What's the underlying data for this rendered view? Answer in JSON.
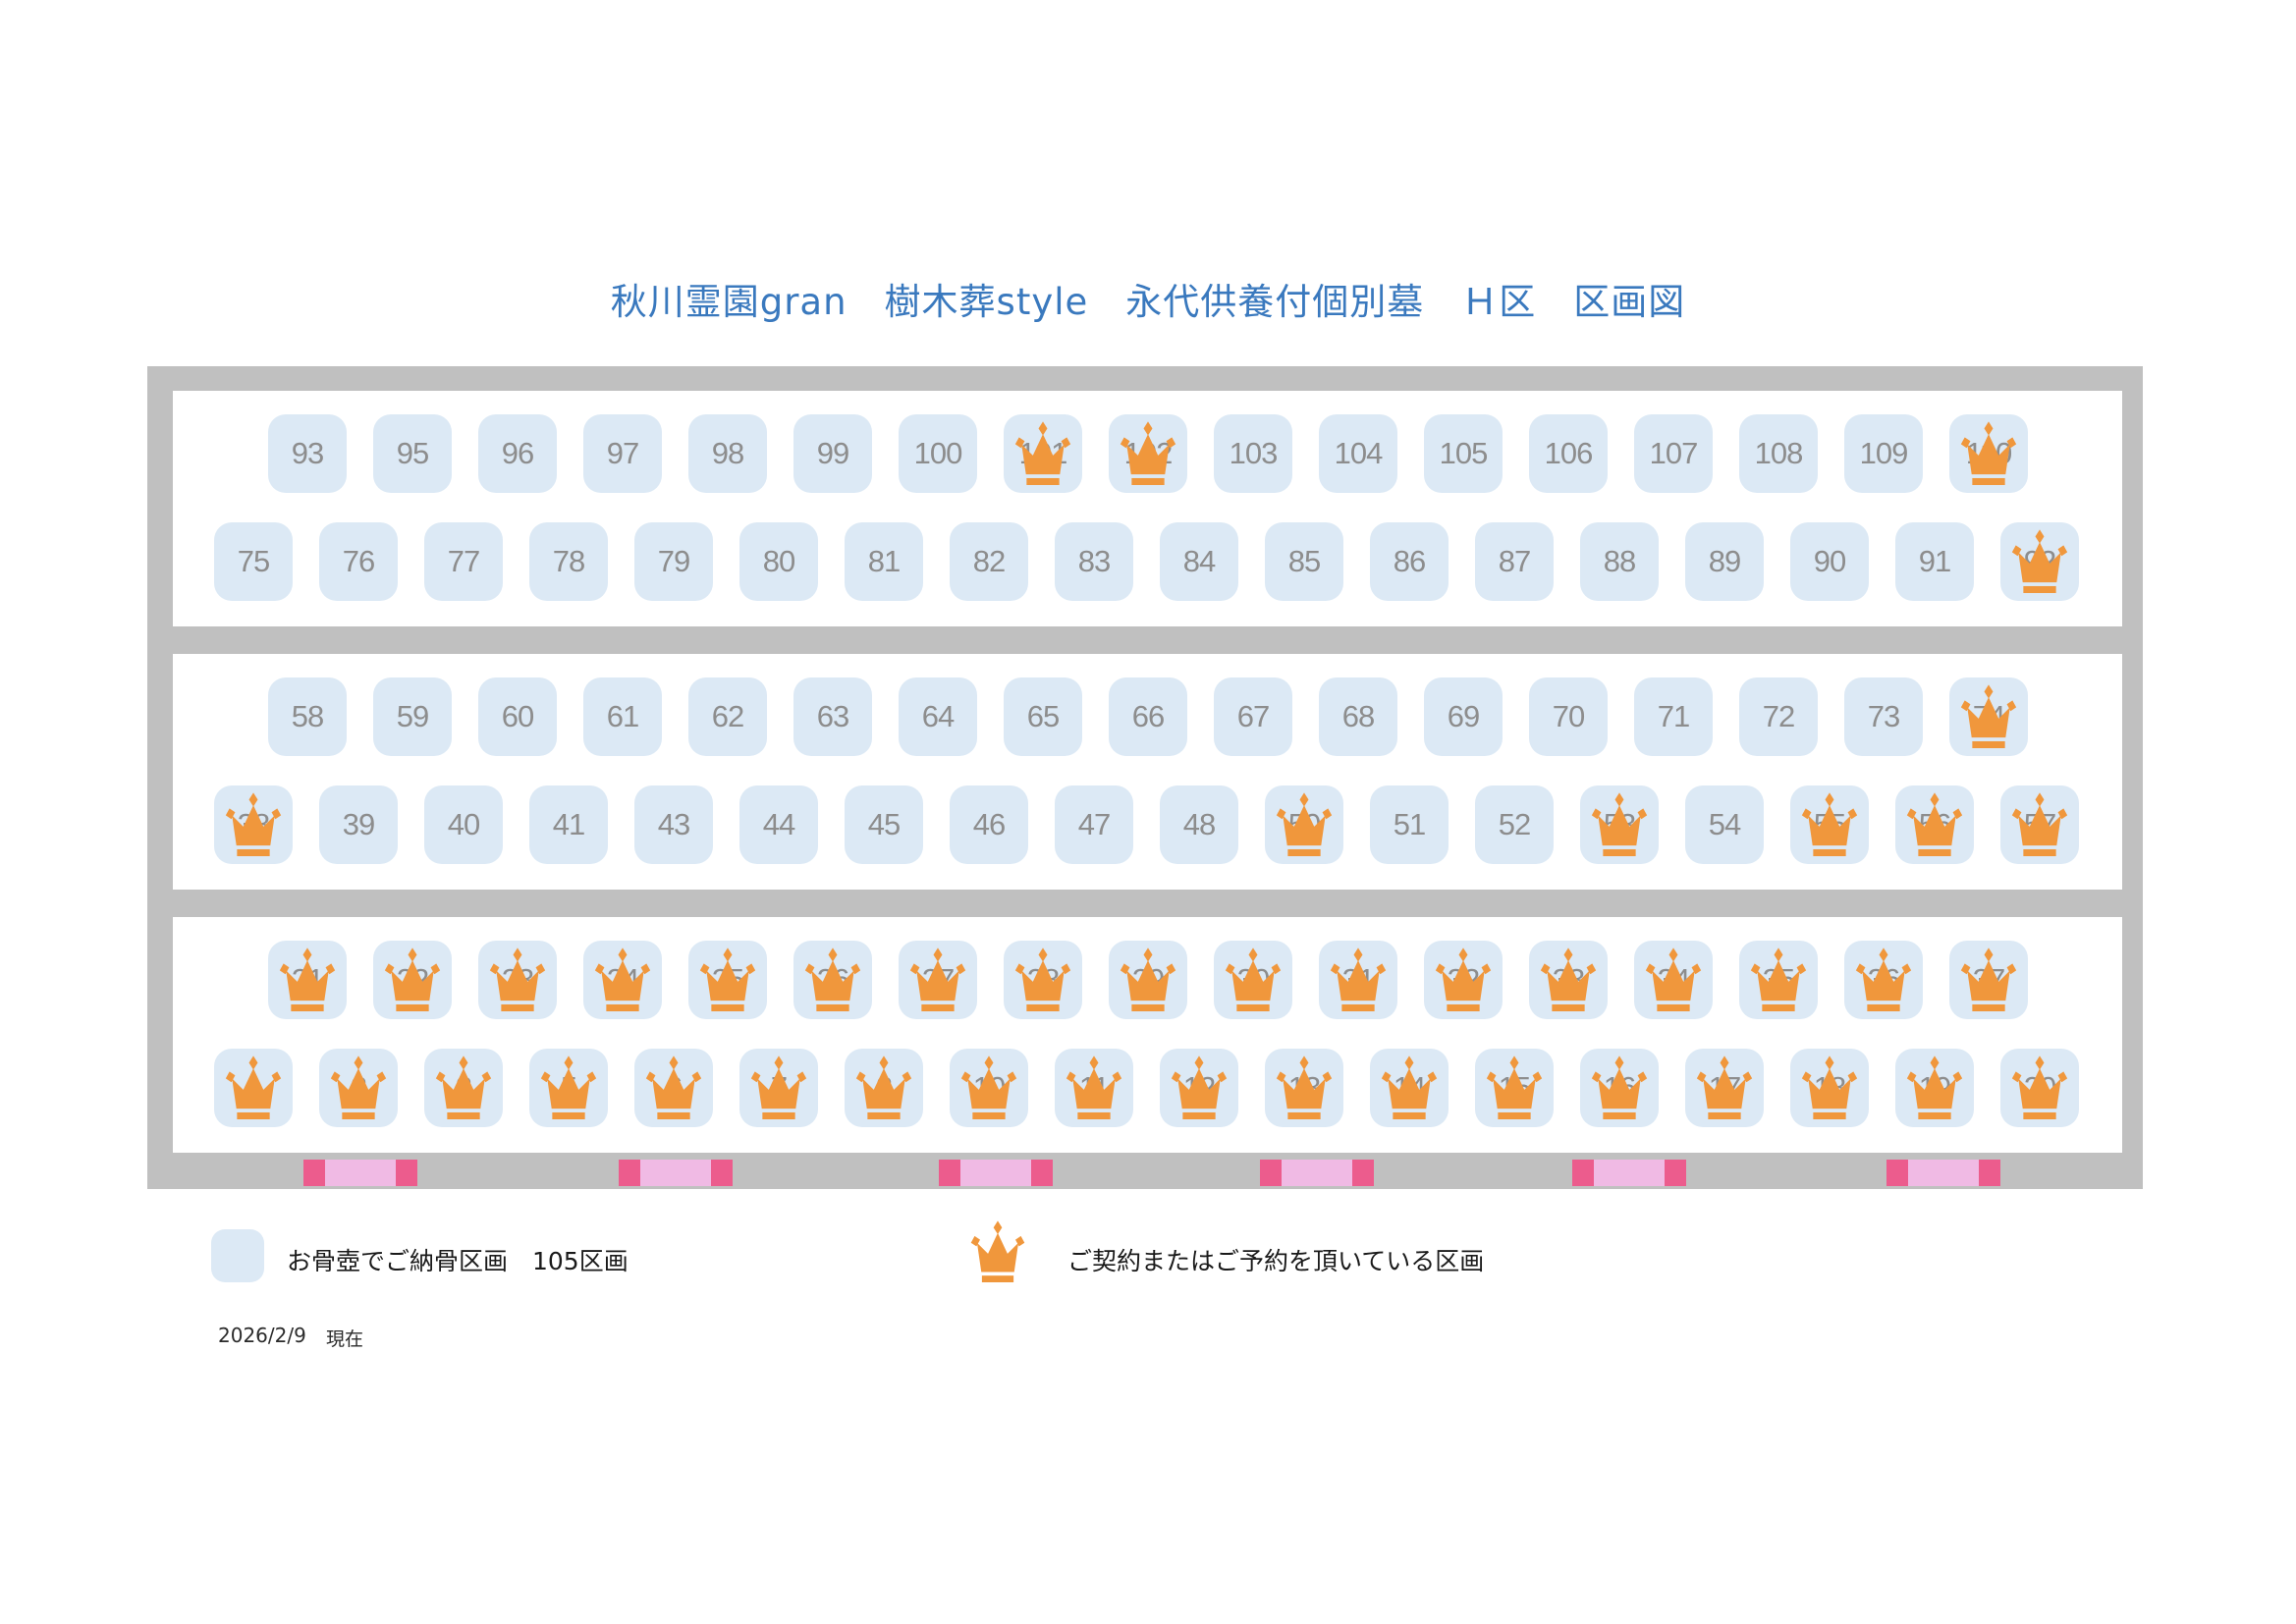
{
  "title": "秋川霊園gran　樹木葬style　永代供養付個別墓　Ｈ区　区画図",
  "colors": {
    "title_blue": "#3A79BE",
    "cell_background": "#DCE9F5",
    "number_gray": "#8D8D8D",
    "frame_gray": "#C0C0C0",
    "crown_orange": "#F0973C",
    "marker_dark_pink": "#EC5C8D",
    "marker_light_pink": "#F0BAE4"
  },
  "map": {
    "path_marker_count": 6,
    "rows": [
      {
        "lines": [
          {
            "cells": [
              {
                "n": "93"
              },
              {
                "n": "95"
              },
              {
                "n": "96"
              },
              {
                "n": "97"
              },
              {
                "n": "98"
              },
              {
                "n": "99"
              },
              {
                "n": "100"
              },
              {
                "n": "101",
                "crown": true
              },
              {
                "n": "102",
                "crown": true
              },
              {
                "n": "103"
              },
              {
                "n": "104"
              },
              {
                "n": "105"
              },
              {
                "n": "106"
              },
              {
                "n": "107"
              },
              {
                "n": "108"
              },
              {
                "n": "109"
              },
              {
                "n": "110",
                "crown": true
              }
            ]
          },
          {
            "cells": [
              {
                "n": "75"
              },
              {
                "n": "76"
              },
              {
                "n": "77"
              },
              {
                "n": "78"
              },
              {
                "n": "79"
              },
              {
                "n": "80"
              },
              {
                "n": "81"
              },
              {
                "n": "82"
              },
              {
                "n": "83"
              },
              {
                "n": "84"
              },
              {
                "n": "85"
              },
              {
                "n": "86"
              },
              {
                "n": "87"
              },
              {
                "n": "88"
              },
              {
                "n": "89"
              },
              {
                "n": "90"
              },
              {
                "n": "91"
              },
              {
                "n": "92",
                "crown": true
              }
            ]
          }
        ]
      },
      {
        "lines": [
          {
            "cells": [
              {
                "n": "58"
              },
              {
                "n": "59"
              },
              {
                "n": "60"
              },
              {
                "n": "61"
              },
              {
                "n": "62"
              },
              {
                "n": "63"
              },
              {
                "n": "64"
              },
              {
                "n": "65"
              },
              {
                "n": "66"
              },
              {
                "n": "67"
              },
              {
                "n": "68"
              },
              {
                "n": "69"
              },
              {
                "n": "70"
              },
              {
                "n": "71"
              },
              {
                "n": "72"
              },
              {
                "n": "73"
              },
              {
                "n": "74",
                "crown": true
              }
            ]
          },
          {
            "cells": [
              {
                "n": "38",
                "crown": true
              },
              {
                "n": "39"
              },
              {
                "n": "40"
              },
              {
                "n": "41"
              },
              {
                "n": "43"
              },
              {
                "n": "44"
              },
              {
                "n": "45"
              },
              {
                "n": "46"
              },
              {
                "n": "47"
              },
              {
                "n": "48"
              },
              {
                "n": "50",
                "crown": true
              },
              {
                "n": "51"
              },
              {
                "n": "52"
              },
              {
                "n": "53",
                "crown": true
              },
              {
                "n": "54"
              },
              {
                "n": "55",
                "crown": true
              },
              {
                "n": "56",
                "crown": true
              },
              {
                "n": "57",
                "crown": true
              }
            ]
          }
        ]
      },
      {
        "lines": [
          {
            "cells": [
              {
                "n": "21",
                "crown": true
              },
              {
                "n": "22",
                "crown": true
              },
              {
                "n": "23",
                "crown": true
              },
              {
                "n": "24",
                "crown": true
              },
              {
                "n": "25",
                "crown": true
              },
              {
                "n": "26",
                "crown": true
              },
              {
                "n": "27",
                "crown": true
              },
              {
                "n": "28",
                "crown": true
              },
              {
                "n": "29",
                "crown": true
              },
              {
                "n": "30",
                "crown": true
              },
              {
                "n": "31",
                "crown": true
              },
              {
                "n": "32",
                "crown": true
              },
              {
                "n": "33",
                "crown": true
              },
              {
                "n": "34",
                "crown": true
              },
              {
                "n": "35",
                "crown": true
              },
              {
                "n": "36",
                "crown": true
              },
              {
                "n": "37",
                "crown": true
              }
            ]
          },
          {
            "cells": [
              {
                "n": "1",
                "crown": true
              },
              {
                "n": "2",
                "crown": true
              },
              {
                "n": "3",
                "crown": true
              },
              {
                "n": "5",
                "crown": true
              },
              {
                "n": "6",
                "crown": true
              },
              {
                "n": "7",
                "crown": true
              },
              {
                "n": "8",
                "crown": true
              },
              {
                "n": "10",
                "crown": true
              },
              {
                "n": "11",
                "crown": true
              },
              {
                "n": "12",
                "crown": true
              },
              {
                "n": "13",
                "crown": true
              },
              {
                "n": "14",
                "crown": true
              },
              {
                "n": "15",
                "crown": true
              },
              {
                "n": "16",
                "crown": true
              },
              {
                "n": "17",
                "crown": true
              },
              {
                "n": "18",
                "crown": true
              },
              {
                "n": "19",
                "crown": true
              },
              {
                "n": "20",
                "crown": true
              }
            ]
          }
        ]
      }
    ]
  },
  "legend": {
    "urn_label": "お骨壺でご納骨区画　105区画",
    "reserved_label": "ご契約またはご予約を頂いている区画",
    "swatch_icon": "plot-swatch",
    "crown_icon": "crown-icon"
  },
  "footer": {
    "date": "2026/2/9",
    "asof_label": "現在"
  }
}
